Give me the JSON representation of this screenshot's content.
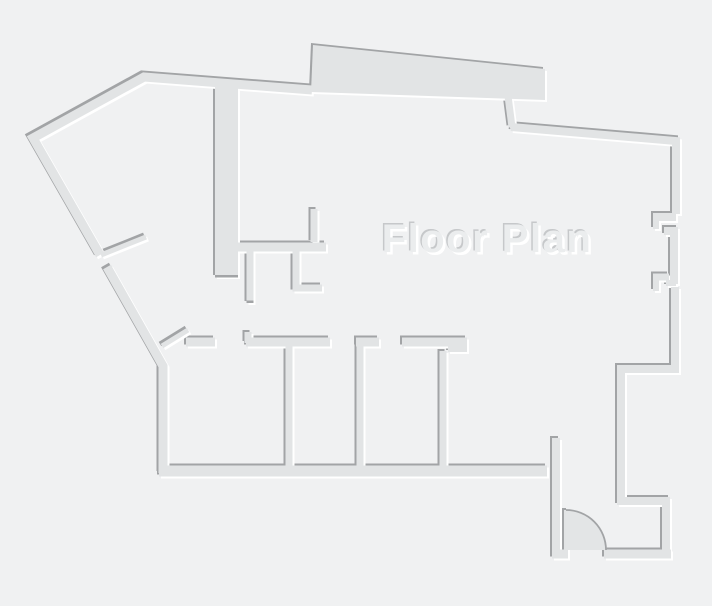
{
  "title": {
    "text": "Floor Plan"
  },
  "canvas": {
    "width": 712,
    "height": 606,
    "background": "#f0f1f2"
  },
  "palette": {
    "wall_fill": "#e2e4e5",
    "edge_shadow": "#a2a4a6",
    "edge_highlight": "#ffffff",
    "door_fill": "#e3e5e6",
    "title_fill": "#ebedee",
    "title_shadow_dark": "#c6c8ca",
    "title_shadow_light": "#ffffff"
  },
  "emboss_offset": 2,
  "plan": {
    "strokes": [
      {
        "id": "outer-northwest-wall",
        "w": 9,
        "pts": [
          [
            100,
            255
          ],
          [
            33,
            138
          ],
          [
            144,
            77
          ],
          [
            312,
            90
          ]
        ]
      },
      {
        "id": "outer-west-lower-wall",
        "w": 9,
        "pts": [
          [
            107,
            267
          ],
          [
            163,
            366
          ],
          [
            163,
            473
          ]
        ]
      },
      {
        "id": "rooms-bottom-wall",
        "w": 11,
        "pts": [
          [
            159,
            471
          ],
          [
            547,
            471
          ]
        ]
      },
      {
        "id": "room-top-wall-1",
        "w": 9,
        "pts": [
          [
            186,
            342
          ],
          [
            215,
            342
          ]
        ]
      },
      {
        "id": "room-top-wall-2",
        "w": 9,
        "pts": [
          [
            246,
            342
          ],
          [
            330,
            342
          ]
        ]
      },
      {
        "id": "room-top-wall-2-notch",
        "w": 7,
        "pts": [
          [
            248,
            343
          ],
          [
            248,
            332
          ]
        ]
      },
      {
        "id": "room-top-wall-3",
        "w": 9,
        "pts": [
          [
            356,
            342
          ],
          [
            379,
            342
          ]
        ]
      },
      {
        "id": "room-top-wall-4",
        "w": 9,
        "pts": [
          [
            402,
            342
          ],
          [
            467,
            342
          ]
        ]
      },
      {
        "id": "room-top-wall-4-block",
        "w": 14,
        "pts": [
          [
            448,
            345
          ],
          [
            467,
            345
          ]
        ]
      },
      {
        "id": "partition-a",
        "w": 7,
        "pts": [
          [
            289,
            346
          ],
          [
            289,
            470
          ]
        ]
      },
      {
        "id": "partition-b",
        "w": 7,
        "pts": [
          [
            360,
            346
          ],
          [
            360,
            470
          ]
        ]
      },
      {
        "id": "partition-c",
        "w": 7,
        "pts": [
          [
            443,
            351
          ],
          [
            443,
            470
          ]
        ]
      },
      {
        "id": "t-wall-horizontal",
        "w": 9,
        "pts": [
          [
            236,
            247
          ],
          [
            326,
            247
          ]
        ]
      },
      {
        "id": "t-wall-stub-up",
        "w": 7,
        "pts": [
          [
            314,
            242
          ],
          [
            314,
            209
          ]
        ]
      },
      {
        "id": "hanging-wall-1",
        "w": 7,
        "pts": [
          [
            250,
            251
          ],
          [
            250,
            303
          ]
        ]
      },
      {
        "id": "hanging-wall-2",
        "w": 7,
        "pts": [
          [
            296,
            251
          ],
          [
            296,
            288
          ],
          [
            322,
            288
          ]
        ]
      },
      {
        "id": "bump-connector",
        "w": 7,
        "pts": [
          [
            508,
            96
          ],
          [
            512,
            127
          ]
        ]
      },
      {
        "id": "outer-northeast-wall",
        "w": 8,
        "pts": [
          [
            511,
            127
          ],
          [
            676,
            141
          ],
          [
            676,
            214
          ]
        ]
      },
      {
        "id": "east-bracket-a",
        "w": 8,
        "pts": [
          [
            653,
            217
          ],
          [
            676,
            217
          ]
        ]
      },
      {
        "id": "east-bracket-a-stub",
        "w": 6,
        "pts": [
          [
            656,
            214
          ],
          [
            656,
            229
          ]
        ]
      },
      {
        "id": "east-mid-wall",
        "w": 8,
        "pts": [
          [
            664,
            231
          ],
          [
            674,
            231
          ],
          [
            674,
            284
          ]
        ]
      },
      {
        "id": "east-bracket-b",
        "w": 7,
        "pts": [
          [
            653,
            277
          ],
          [
            669,
            277
          ]
        ]
      },
      {
        "id": "east-bracket-b-stub",
        "w": 6,
        "pts": [
          [
            656,
            277
          ],
          [
            656,
            291
          ]
        ]
      },
      {
        "id": "east-bracket-b-foot",
        "w": 6,
        "pts": [
          [
            666,
            283
          ],
          [
            676,
            283
          ]
        ]
      },
      {
        "id": "east-wall-lower",
        "w": 8,
        "pts": [
          [
            675,
            287
          ],
          [
            675,
            369
          ]
        ]
      },
      {
        "id": "east-step-wall",
        "w": 8,
        "pts": [
          [
            679,
            369
          ],
          [
            621,
            369
          ],
          [
            621,
            501
          ],
          [
            670,
            501
          ]
        ]
      },
      {
        "id": "porch-right-wall",
        "w": 8,
        "pts": [
          [
            666,
            501
          ],
          [
            666,
            554
          ]
        ]
      },
      {
        "id": "porch-bottom-wall-left",
        "w": 9,
        "pts": [
          [
            552,
            554
          ],
          [
            568,
            554
          ]
        ]
      },
      {
        "id": "porch-bottom-wall-right",
        "w": 9,
        "pts": [
          [
            604,
            554
          ],
          [
            671,
            554
          ]
        ]
      },
      {
        "id": "entry-wall",
        "w": 8,
        "pts": [
          [
            556,
            438
          ],
          [
            556,
            558
          ]
        ]
      },
      {
        "id": "entry-door-leaf",
        "w": 4,
        "pts": [
          [
            566,
            510
          ],
          [
            566,
            550
          ]
        ]
      },
      {
        "id": "door-leaf-northwest",
        "w": 5,
        "pts": [
          [
            101,
            255
          ],
          [
            146,
            237
          ]
        ]
      },
      {
        "id": "door-leaf-west",
        "w": 5,
        "pts": [
          [
            162,
            346
          ],
          [
            188,
            330
          ]
        ]
      }
    ],
    "polygons": [
      {
        "id": "top-band",
        "pts": [
          [
            313,
            45
          ],
          [
            545,
            69
          ],
          [
            545,
            100
          ],
          [
            311,
            92
          ]
        ]
      },
      {
        "id": "thick-corridor-wall",
        "pts": [
          [
            215,
            80
          ],
          [
            238,
            82
          ],
          [
            238,
            277
          ],
          [
            215,
            277
          ]
        ]
      }
    ],
    "caps": [
      {
        "x": 215,
        "y": 275,
        "w": 23,
        "h": 2.5
      },
      {
        "x": 246.5,
        "y": 300.5,
        "w": 7,
        "h": 2.5
      }
    ],
    "door": {
      "cx": 566,
      "cy": 550,
      "r": 40
    }
  }
}
